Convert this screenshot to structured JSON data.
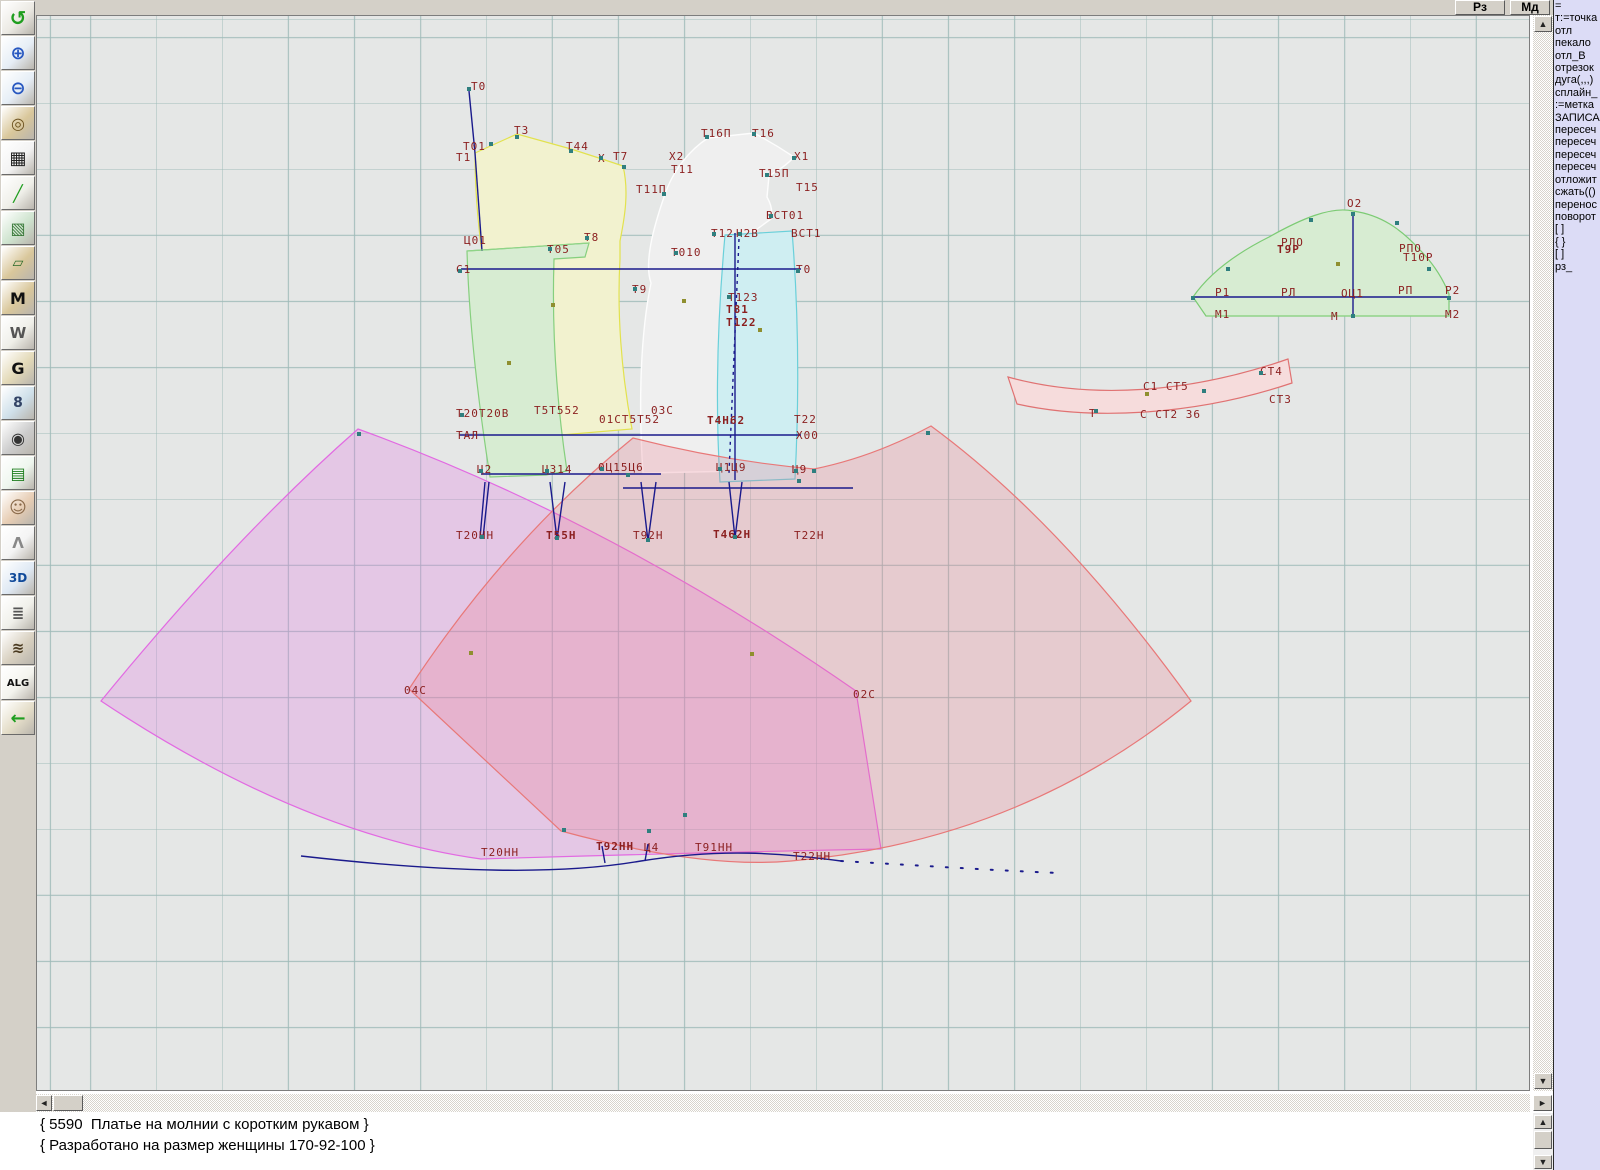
{
  "topbar": {
    "rz_label": "Рз",
    "md_label": "Мд"
  },
  "icons": {
    "up": "▲",
    "down": "▼",
    "left": "◄",
    "right": "►"
  },
  "toolbar": {
    "buttons": [
      {
        "name": "undo-icon",
        "glyph": "↺",
        "fg": "#1f9e1f",
        "bg": "#eceae4",
        "fs": 20
      },
      {
        "name": "zoom-in-icon",
        "glyph": "⊕",
        "fg": "#2757c0",
        "bg": "#e6eef6",
        "fs": 18
      },
      {
        "name": "zoom-out-icon",
        "glyph": "⊖",
        "fg": "#2757c0",
        "bg": "#e6eef6",
        "fs": 18
      },
      {
        "name": "pattern-preview-icon",
        "glyph": "◎",
        "fg": "#6d5320",
        "bg": "#d9c79b",
        "fs": 16
      },
      {
        "name": "grid-icon",
        "glyph": "▦",
        "fg": "#222222",
        "bg": "#f3f3f3",
        "fs": 18
      },
      {
        "name": "measure-line-icon",
        "glyph": "╱",
        "fg": "#1f9e1f",
        "bg": "#efefe9",
        "fs": 16
      },
      {
        "name": "image-icon",
        "glyph": "▧",
        "fg": "#3a7a3a",
        "bg": "#cfe4cf",
        "fs": 16
      },
      {
        "name": "pattern-piece-icon",
        "glyph": "▱",
        "fg": "#2a6a2a",
        "bg": "#d9c79b",
        "fs": 14
      },
      {
        "name": "pattern-m-icon",
        "glyph": "M",
        "fg": "#111111",
        "bg": "#d9c79b",
        "fs": 16
      },
      {
        "name": "drafting-tools-icon",
        "glyph": "W",
        "fg": "#555555",
        "bg": "#efefe9",
        "fs": 15
      },
      {
        "name": "pattern-g-icon",
        "glyph": "G",
        "fg": "#111111",
        "bg": "#e3d9b8",
        "fs": 16
      },
      {
        "name": "ruler-icon",
        "glyph": "8",
        "fg": "#334466",
        "bg": "#cfe0ea",
        "fs": 14
      },
      {
        "name": "camera-icon",
        "glyph": "◉",
        "fg": "#333333",
        "bg": "#cccccc",
        "fs": 16
      },
      {
        "name": "spreadsheet-icon",
        "glyph": "▤",
        "fg": "#1f7e1f",
        "bg": "#eef6ee",
        "fs": 16
      },
      {
        "name": "model-photo-icon",
        "glyph": "☺",
        "fg": "#8a6a4a",
        "bg": "#e7cdb4",
        "fs": 17
      },
      {
        "name": "garment-icon",
        "glyph": "Λ",
        "fg": "#888888",
        "bg": "#f4f4f4",
        "fs": 15
      },
      {
        "name": "3d-icon",
        "glyph": "3D",
        "fg": "#104a9a",
        "bg": "#dfe9f4",
        "fs": 12
      },
      {
        "name": "notes-icon",
        "glyph": "≣",
        "fg": "#555555",
        "bg": "#f0f0ea",
        "fs": 15
      },
      {
        "name": "books-icon",
        "glyph": "≋",
        "fg": "#4a3a20",
        "bg": "#d8d0c0",
        "fs": 15
      },
      {
        "name": "alg-icon",
        "glyph": "ALG",
        "fg": "#111111",
        "bg": "#f4f4ee",
        "fs": 10
      },
      {
        "name": "exit-icon",
        "glyph": "←",
        "fg": "#1f9e1f",
        "bg": "#e4ddc8",
        "fs": 18
      }
    ]
  },
  "right_panel": {
    "lines": [
      "=",
      "т:=точка",
      "отл",
      "пекало",
      "отл_В",
      "отрезок",
      "дуга(,,,)",
      "сплайн_",
      ":=метка",
      "ЗАПИСА",
      "пересеч",
      "пересеч",
      "пересеч",
      "пересеч",
      "отложит",
      "сжать(()",
      "перенос",
      "поворот",
      "[ ]",
      "{ }",
      "[ ]",
      "рз_"
    ]
  },
  "status": {
    "lines": [
      "{ 5590  Платье на молнии с коротким рукавом }",
      "{ Разработано на размер женщины 170-92-100 }"
    ]
  },
  "canvas": {
    "colors": {
      "background": "#e5e7e6",
      "grid": "#9ebab8",
      "label": "#8b1f1f",
      "construction": "#1a1a8c",
      "back_bodice_fill": "#f2f2cf",
      "back_bodice_stroke": "#e2e24e",
      "side_bodice_fill": "#d7ecd2",
      "side_bodice_stroke": "#86cf7e",
      "front_bodice_fill": "#efefef",
      "front_bodice_stroke": "#fdfdfd",
      "front_side_fill": "#cfeef2",
      "front_side_stroke": "#6ad0da",
      "skirt_left_fill": "rgba(226,120,226,0.28)",
      "skirt_left_stroke": "#e26ae2",
      "skirt_right_fill": "rgba(234,118,138,0.25)",
      "skirt_right_stroke": "#e87878",
      "sleeve_fill": "#d7ecd2",
      "sleeve_stroke": "#7ccb74",
      "collar_fill": "#f6dcdc",
      "collar_stroke": "#e07272",
      "point_teal": "#2f7f7f",
      "point_olive": "#8f8f2f"
    },
    "labels": [
      {
        "t": "Т0",
        "x": 470,
        "y": 80
      },
      {
        "t": "Т3",
        "x": 513,
        "y": 124
      },
      {
        "t": "Т01",
        "x": 462,
        "y": 140
      },
      {
        "t": "Т1",
        "x": 455,
        "y": 151
      },
      {
        "t": "Т44",
        "x": 565,
        "y": 140
      },
      {
        "t": "X",
        "x": 597,
        "y": 152
      },
      {
        "t": "Т7",
        "x": 612,
        "y": 150
      },
      {
        "t": "Т16П",
        "x": 700,
        "y": 127
      },
      {
        "t": "Т16",
        "x": 751,
        "y": 127
      },
      {
        "t": "Х2",
        "x": 668,
        "y": 150
      },
      {
        "t": "Х1",
        "x": 793,
        "y": 150
      },
      {
        "t": "Т11",
        "x": 670,
        "y": 163
      },
      {
        "t": "Т15П",
        "x": 758,
        "y": 167
      },
      {
        "t": "Т11П",
        "x": 635,
        "y": 183
      },
      {
        "t": "Т15",
        "x": 795,
        "y": 181
      },
      {
        "t": "ВСТ01",
        "x": 765,
        "y": 209
      },
      {
        "t": "Т12",
        "x": 710,
        "y": 227
      },
      {
        "t": "Н2В",
        "x": 735,
        "y": 227
      },
      {
        "t": "ВСТ1",
        "x": 790,
        "y": 227
      },
      {
        "t": "Ц01",
        "x": 463,
        "y": 234
      },
      {
        "t": "Т8",
        "x": 583,
        "y": 231
      },
      {
        "t": "Т05",
        "x": 546,
        "y": 243
      },
      {
        "t": "Т010",
        "x": 670,
        "y": 246
      },
      {
        "t": "С1",
        "x": 455,
        "y": 263
      },
      {
        "t": "Т0",
        "x": 795,
        "y": 263
      },
      {
        "t": "Т9",
        "x": 631,
        "y": 283
      },
      {
        "t": "Т123",
        "x": 727,
        "y": 291
      },
      {
        "t": "Т81",
        "x": 725,
        "y": 303,
        "b": 1
      },
      {
        "t": "Т122",
        "x": 725,
        "y": 316,
        "b": 1
      },
      {
        "t": "Т20Т20В",
        "x": 455,
        "y": 407
      },
      {
        "t": "Т5Т552",
        "x": 533,
        "y": 404
      },
      {
        "t": "03С",
        "x": 650,
        "y": 404
      },
      {
        "t": "01СТ5Т52",
        "x": 598,
        "y": 413
      },
      {
        "t": "Т4Н62",
        "x": 706,
        "y": 414,
        "b": 1
      },
      {
        "t": "Т22",
        "x": 793,
        "y": 413
      },
      {
        "t": "ТАЛ",
        "x": 455,
        "y": 429
      },
      {
        "t": "Х00",
        "x": 795,
        "y": 429
      },
      {
        "t": "Ц2",
        "x": 476,
        "y": 463
      },
      {
        "t": "Ц314",
        "x": 541,
        "y": 463
      },
      {
        "t": "0Ц15Ц6",
        "x": 597,
        "y": 461
      },
      {
        "t": "Ц1Ц9",
        "x": 715,
        "y": 461
      },
      {
        "t": "Ц9",
        "x": 791,
        "y": 463
      },
      {
        "t": "Т20НН",
        "x": 455,
        "y": 529
      },
      {
        "t": "Т55Н",
        "x": 545,
        "y": 529,
        "b": 1
      },
      {
        "t": "Т92Н",
        "x": 632,
        "y": 529
      },
      {
        "t": "Т462Н",
        "x": 712,
        "y": 528,
        "b": 1
      },
      {
        "t": "Т22Н",
        "x": 793,
        "y": 529
      },
      {
        "t": "04С",
        "x": 403,
        "y": 684
      },
      {
        "t": "02С",
        "x": 852,
        "y": 688
      },
      {
        "t": "Т20НН",
        "x": 480,
        "y": 846
      },
      {
        "t": "Т92НН",
        "x": 595,
        "y": 840,
        "b": 1
      },
      {
        "t": "Ц4",
        "x": 643,
        "y": 841
      },
      {
        "t": "Т91НН",
        "x": 694,
        "y": 841
      },
      {
        "t": "Т22НН",
        "x": 792,
        "y": 850
      },
      {
        "t": "О2",
        "x": 1346,
        "y": 197
      },
      {
        "t": "РЛО",
        "x": 1280,
        "y": 236
      },
      {
        "t": "Т9Р",
        "x": 1276,
        "y": 243,
        "b": 1
      },
      {
        "t": "РПО",
        "x": 1398,
        "y": 242
      },
      {
        "t": "Т10Р",
        "x": 1402,
        "y": 251
      },
      {
        "t": "Р1",
        "x": 1214,
        "y": 286
      },
      {
        "t": "РЛ",
        "x": 1280,
        "y": 286
      },
      {
        "t": "ОЦ1",
        "x": 1340,
        "y": 287
      },
      {
        "t": "РП",
        "x": 1397,
        "y": 284
      },
      {
        "t": "Р2",
        "x": 1444,
        "y": 284
      },
      {
        "t": "М1",
        "x": 1214,
        "y": 308
      },
      {
        "t": "М",
        "x": 1330,
        "y": 310
      },
      {
        "t": "М2",
        "x": 1444,
        "y": 308
      },
      {
        "t": "СТ4",
        "x": 1259,
        "y": 365
      },
      {
        "t": "С1 СТ5",
        "x": 1142,
        "y": 380
      },
      {
        "t": "СТ3",
        "x": 1268,
        "y": 393
      },
      {
        "t": "С СТ2 36",
        "x": 1139,
        "y": 408
      },
      {
        "t": "Т",
        "x": 1088,
        "y": 407
      }
    ],
    "points": [
      {
        "x": 468,
        "y": 88
      },
      {
        "x": 490,
        "y": 143
      },
      {
        "x": 516,
        "y": 136
      },
      {
        "x": 570,
        "y": 150
      },
      {
        "x": 600,
        "y": 157
      },
      {
        "x": 623,
        "y": 166
      },
      {
        "x": 663,
        "y": 193
      },
      {
        "x": 706,
        "y": 136
      },
      {
        "x": 753,
        "y": 133
      },
      {
        "x": 793,
        "y": 157
      },
      {
        "x": 766,
        "y": 174
      },
      {
        "x": 770,
        "y": 215
      },
      {
        "x": 713,
        "y": 233
      },
      {
        "x": 739,
        "y": 233
      },
      {
        "x": 586,
        "y": 237
      },
      {
        "x": 549,
        "y": 248
      },
      {
        "x": 675,
        "y": 252
      },
      {
        "x": 634,
        "y": 288
      },
      {
        "x": 728,
        "y": 296
      },
      {
        "x": 459,
        "y": 270
      },
      {
        "x": 797,
        "y": 270
      },
      {
        "x": 461,
        "y": 414
      },
      {
        "x": 480,
        "y": 470
      },
      {
        "x": 546,
        "y": 470
      },
      {
        "x": 601,
        "y": 468
      },
      {
        "x": 627,
        "y": 474
      },
      {
        "x": 719,
        "y": 468
      },
      {
        "x": 795,
        "y": 470
      },
      {
        "x": 481,
        "y": 536
      },
      {
        "x": 556,
        "y": 537
      },
      {
        "x": 647,
        "y": 539
      },
      {
        "x": 734,
        "y": 536
      },
      {
        "x": 798,
        "y": 480
      },
      {
        "x": 563,
        "y": 829
      },
      {
        "x": 648,
        "y": 830
      },
      {
        "x": 684,
        "y": 814
      },
      {
        "x": 508,
        "y": 362,
        "c": "o"
      },
      {
        "x": 552,
        "y": 304,
        "c": "o"
      },
      {
        "x": 683,
        "y": 300,
        "c": "o"
      },
      {
        "x": 759,
        "y": 329,
        "c": "o"
      },
      {
        "x": 470,
        "y": 652,
        "c": "o"
      },
      {
        "x": 751,
        "y": 653,
        "c": "o"
      },
      {
        "x": 1337,
        "y": 263,
        "c": "o"
      },
      {
        "x": 1227,
        "y": 268
      },
      {
        "x": 1310,
        "y": 219
      },
      {
        "x": 1396,
        "y": 222
      },
      {
        "x": 1428,
        "y": 268
      },
      {
        "x": 1352,
        "y": 213
      },
      {
        "x": 1352,
        "y": 315
      },
      {
        "x": 1192,
        "y": 297
      },
      {
        "x": 1448,
        "y": 297
      },
      {
        "x": 1203,
        "y": 390
      },
      {
        "x": 1260,
        "y": 372
      },
      {
        "x": 1146,
        "y": 393,
        "c": "o"
      },
      {
        "x": 1095,
        "y": 410
      },
      {
        "x": 927,
        "y": 432
      },
      {
        "x": 813,
        "y": 470
      },
      {
        "x": 358,
        "y": 433
      }
    ]
  }
}
